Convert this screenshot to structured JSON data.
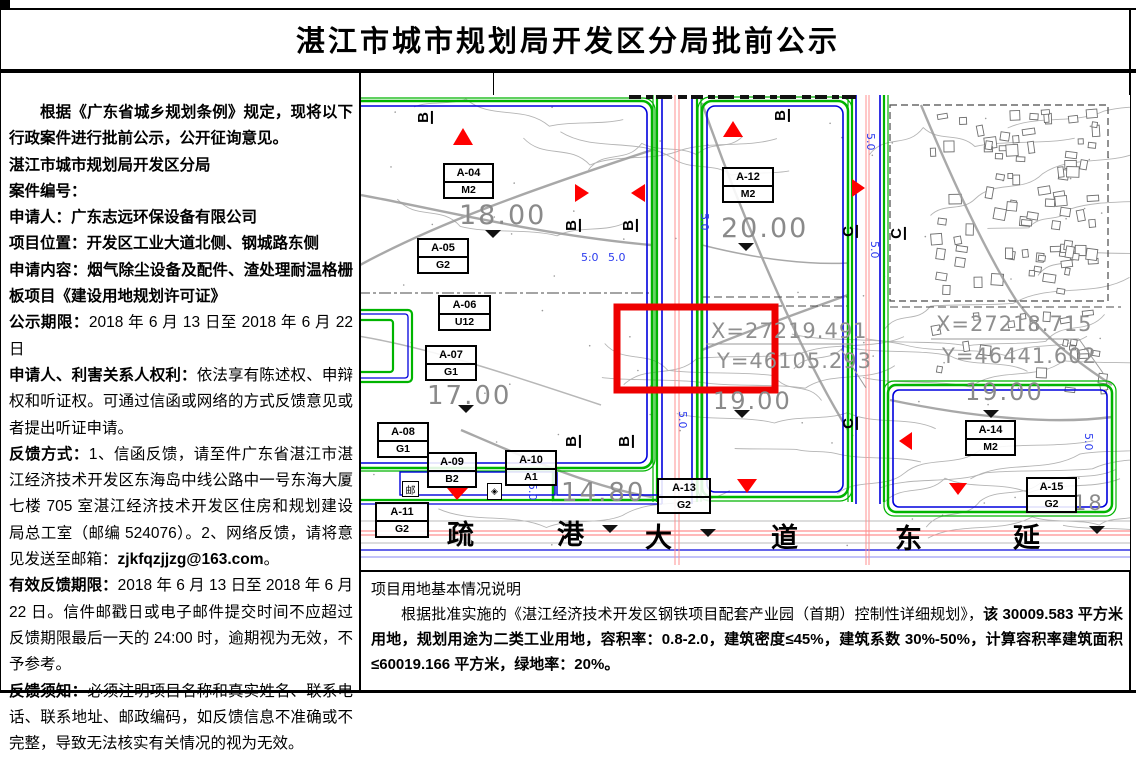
{
  "page": {
    "title": "湛江市城市规划局开发区分局批前公示"
  },
  "left_panel": {
    "intro": "根据《广东省城乡规划条例》规定，现将以下行政案件进行批前公示，公开征询意见。",
    "bureau": "湛江市城市规划局开发区分局",
    "case_no_label": "案件编号：",
    "applicant_label": "申请人：",
    "applicant": "广东志远环保设备有限公司",
    "location_label": "项目位置：",
    "location": "开发区工业大道北侧、钢城路东侧",
    "content_label": "申请内容：",
    "content": "烟气除尘设备及配件、渣处理耐温格栅板项目《建设用地规划许可证》",
    "period_label": "公示期限：",
    "period": "2018 年 6 月 13 日至 2018 年 6 月 22 日",
    "rights_label": "申请人、利害关系人权利：",
    "rights": "依法享有陈述权、申辩权和听证权。可通过信函或网络的方式反馈意见或者提出听证申请。",
    "feedback_label": "反馈方式：",
    "feedback_body": "1、信函反馈，请至件广东省湛江市湛江经济技术开发区东海岛中线公路中一号东海大厦七楼 705 室湛江经济技术开发区住房和规划建设局总工室（邮编 524076）。2、网络反馈，请将意见发送至邮箱：",
    "feedback_email": "zjkfqzjjzg@163.com",
    "feedback_tail": "。",
    "valid_label": "有效反馈期限：",
    "valid": "2018 年 6 月 13 日至 2018 年 6 月 22 日。信件邮戳日或电子邮件提交时间不应超过反馈期限最后一天的 24:00 时，逾期视为无效，不予参考。",
    "must_label": "反馈须知：",
    "must": "必须注明项目名称和真实姓名、联系电话、联系地址、邮政编码，如反馈信息不准确或不完整，导致无法核实有关情况的视为无效。"
  },
  "bottom_panel": {
    "heading": "项目用地基本情况说明",
    "body_regular": "根据批准实施的《湛江经济技术开发区钢铁项目配套产业园（首期）控制性详细规划》，",
    "body_bold": "该 30009.583 平方米用地，规划用途为二类工业用地，容积率：0.8-2.0，建筑密度≤45%，建筑系数 30%-50%，计算容积率建筑面积≤60019.166 平方米，绿地率：20%。"
  },
  "map": {
    "parcels": [
      {
        "code": "A-04",
        "type": "M2"
      },
      {
        "code": "A-05",
        "type": "G2"
      },
      {
        "code": "A-06",
        "type": "U12"
      },
      {
        "code": "A-07",
        "type": "G1"
      },
      {
        "code": "A-08",
        "type": "G1"
      },
      {
        "code": "A-09",
        "type": "B2"
      },
      {
        "code": "A-10",
        "type": "A1"
      },
      {
        "code": "A-11",
        "type": "G2"
      },
      {
        "code": "A-12",
        "type": "M2"
      },
      {
        "code": "A-13",
        "type": "G2"
      },
      {
        "code": "A-14",
        "type": "M2"
      },
      {
        "code": "A-15",
        "type": "G2"
      }
    ],
    "elevations": [
      "18.00",
      "20.00",
      "17.00",
      "19.00",
      "19.00",
      "14.80"
    ],
    "partial_elevation": "18",
    "coordinates": [
      {
        "x": "X=27219.491",
        "y": "Y=46105.293"
      },
      {
        "x": "X=27218.715",
        "y": "Y=46441.602"
      }
    ],
    "road_name_chars": [
      "疏",
      "港",
      "大",
      "道",
      "东",
      "延"
    ],
    "dim_label": "5.0",
    "stop_b": "B",
    "stop_c": "C",
    "post_icon": "邮",
    "crest_icon": "◈",
    "colors": {
      "boundary_green": "#00b400",
      "boundary_blue": "#0000dd",
      "centerline_red": "#ff9090",
      "highlight_red": "#ee0000",
      "contour_gray": "#b4b4b4"
    }
  }
}
